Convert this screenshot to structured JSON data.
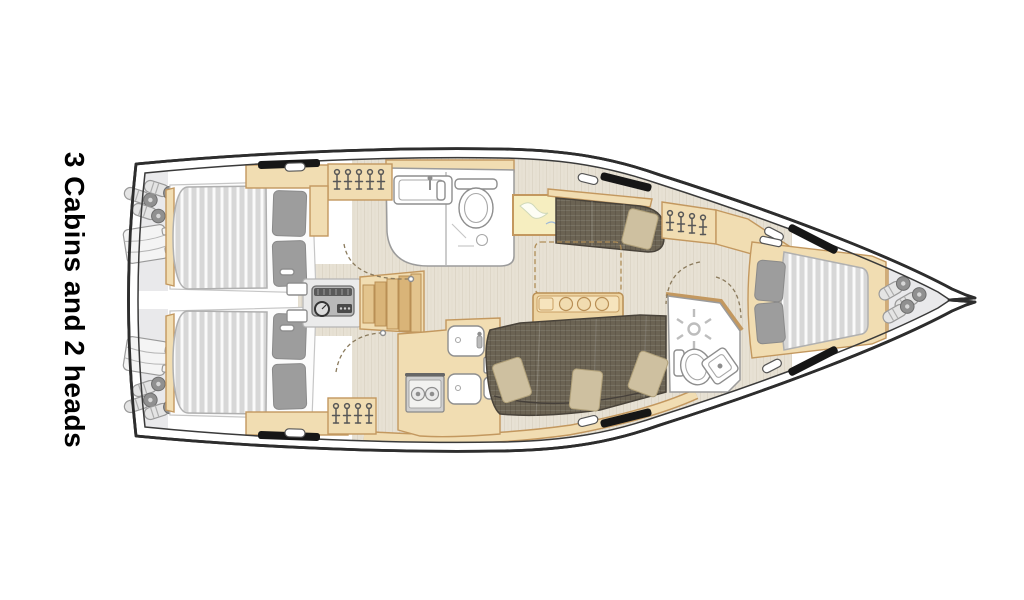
{
  "caption": {
    "text": "3 Cabins and 2 heads"
  },
  "diagram": {
    "type": "sailing-yacht-interior-floor-plan",
    "orientation": "bow-right",
    "cabins": 3,
    "heads": 2
  },
  "colors": {
    "background": "#ffffff",
    "text": "#000000",
    "hull-line": "#2d2d2d",
    "deck-line": "#3a3a3a",
    "wood": "#f1ddb2",
    "wood-line": "#c3985f",
    "floor": "#e7e1d4",
    "floor-grain": "#d5cdbc",
    "locker": "#e9e9eb",
    "mattress": "#d7d7d7",
    "mattress-stripe": "#fafafa",
    "pillow-gray": "#9d9d9d",
    "sofa": "#6b6353",
    "sofa-line": "#49433a",
    "sofa-pillow": "#cec0a0",
    "fixture": "#ffffff",
    "fixture-line": "#8e8e8e",
    "engine": "#b9b9b9",
    "black-fitting": "#161616",
    "chart-paper": "#f6eec0"
  }
}
